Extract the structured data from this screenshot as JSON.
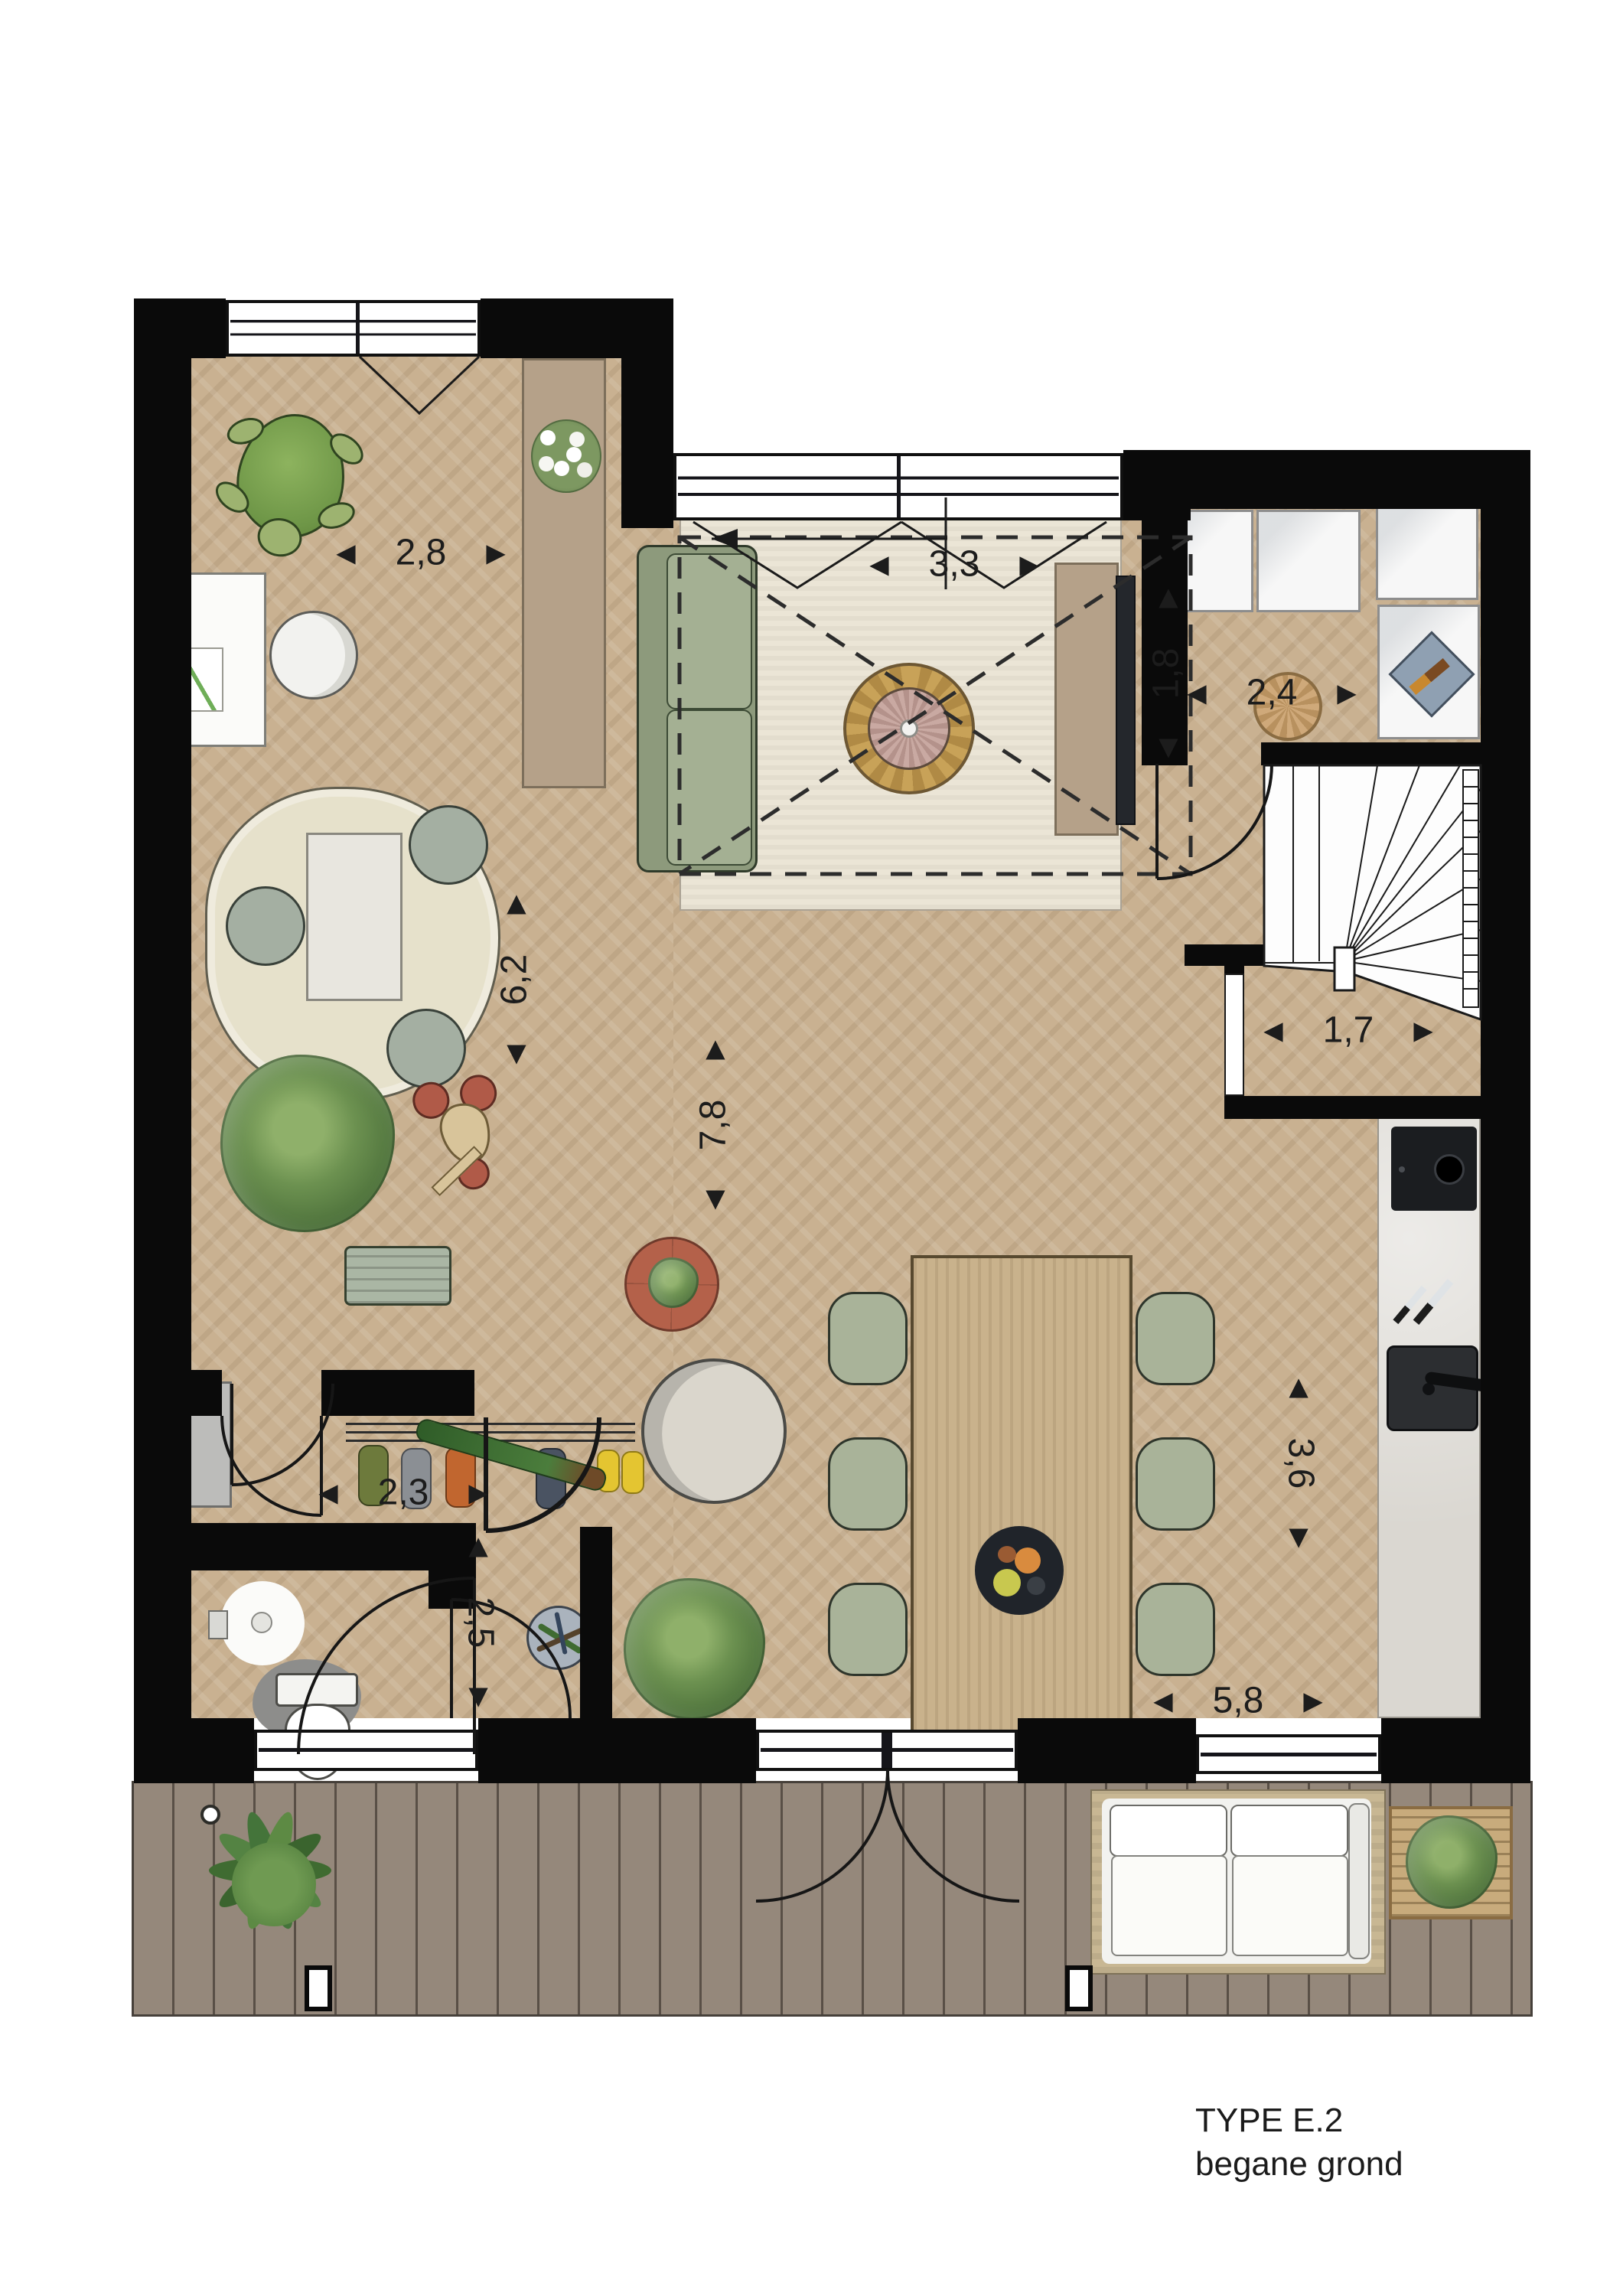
{
  "title": {
    "line1": "TYPE E.2",
    "line2": "begane grond"
  },
  "dimensions": {
    "study_width": "2,8",
    "living_width": "3,3",
    "utility_width": "2,4",
    "utility_depth": "1,8",
    "left_zone_depth": "6,2",
    "main_depth": "7,8",
    "stair_closet_width": "1,7",
    "hall_width": "2,3",
    "hall_depth": "2,5",
    "kitchen_depth": "3,6",
    "dining_width": "5,8"
  },
  "arrows": {
    "left": "◀",
    "right": "▶"
  },
  "colors": {
    "wall": "#0a0a0a",
    "wood_floor": "#c9b191",
    "deck": "#95887b",
    "living_rug": "#ebe5d6",
    "sofa_green": "#9fab8e",
    "cabinet_tan": "#b5a189",
    "kitchen_counter": "#dad7d1",
    "appliance_white": "#f7f7f7"
  }
}
